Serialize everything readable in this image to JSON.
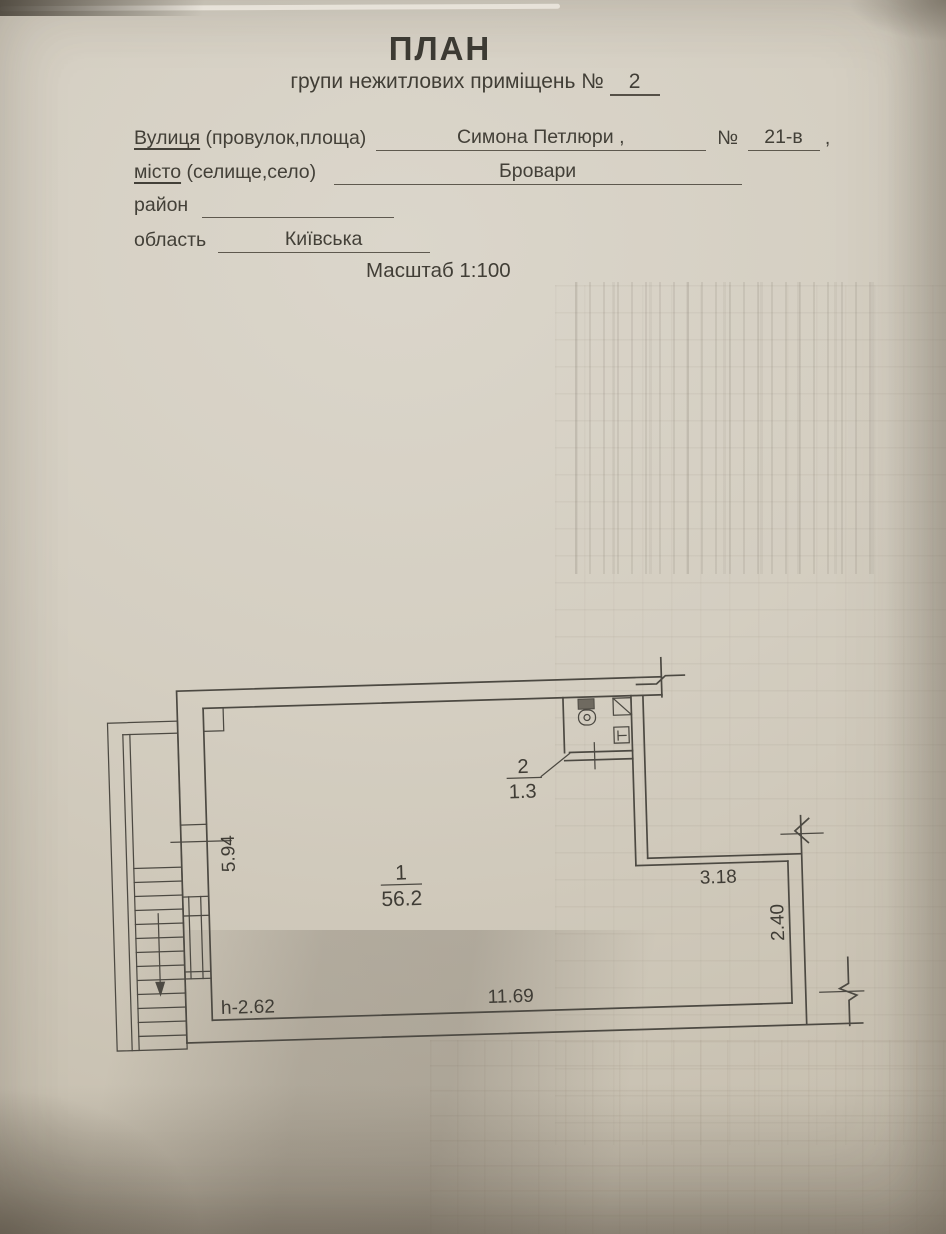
{
  "page": {
    "title": "ПЛАН",
    "subtitle": "групи нежитлових приміщень №",
    "subtitle_number": "2",
    "scale": "Масштаб 1:100",
    "fields": [
      {
        "label_u": "Вулиця",
        "label": " (провулок,площа)",
        "value": "Симона Петлюри ,",
        "label2": "№",
        "value2": "21-в",
        "suffix2": ","
      },
      {
        "label_u": "місто",
        "label": " (селище,село)",
        "value": "Бровари"
      },
      {
        "label_u": "",
        "label": "район",
        "value": ""
      },
      {
        "label_u": "",
        "label": "область",
        "value": "Київська"
      }
    ]
  },
  "plan": {
    "room1": {
      "number": "1",
      "area": "56.2"
    },
    "room2": {
      "number": "2",
      "area": "1.3"
    },
    "dims": {
      "left": "5.94",
      "top_right": "3.18",
      "right": "2.40",
      "bottom": "11.69",
      "height": "h-2.62"
    }
  },
  "colors": {
    "paper": "#d4cec1",
    "ink": "#43403a",
    "line": "#4c4942"
  }
}
